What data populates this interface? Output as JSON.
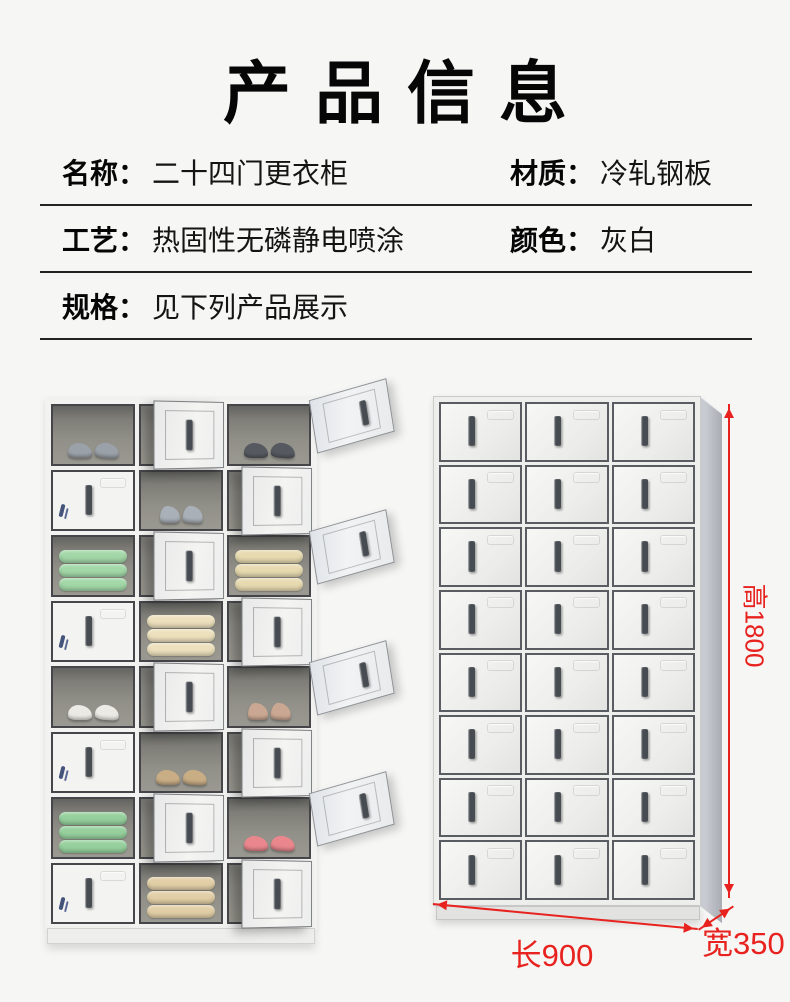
{
  "title": "产品信息",
  "specs": {
    "rows": [
      {
        "left_label": "名称：",
        "left_value": "二十四门更衣柜",
        "right_label": "材质：",
        "right_value": "冷轧钢板"
      },
      {
        "left_label": "工艺：",
        "left_value": "热固性无磷静电喷涂",
        "right_label": "颜色：",
        "right_value": "灰白"
      },
      {
        "left_label": "规格：",
        "left_value": "见下列产品展示",
        "right_label": "",
        "right_value": ""
      }
    ]
  },
  "display": {
    "left_locker": {
      "rows": 8,
      "cols": 3,
      "description": "open 24-door locker showing contents",
      "cells": [
        {
          "type": "open",
          "item": "shoes",
          "color": "#9ba1a8"
        },
        {
          "type": "door"
        },
        {
          "type": "open",
          "item": "shoes",
          "color": "#565a60",
          "outer_door": true
        },
        {
          "type": "closed"
        },
        {
          "type": "open",
          "item": "heels",
          "color": "#a9b0b7"
        },
        {
          "type": "door"
        },
        {
          "type": "open",
          "item": "towels",
          "color": "#a2d7a7"
        },
        {
          "type": "door"
        },
        {
          "type": "open",
          "item": "towels",
          "color": "#e7dab0",
          "outer_door": true
        },
        {
          "type": "closed"
        },
        {
          "type": "open",
          "item": "towels",
          "color": "#ece0bd"
        },
        {
          "type": "door"
        },
        {
          "type": "open",
          "item": "shoes",
          "color": "#eceae5"
        },
        {
          "type": "door"
        },
        {
          "type": "open",
          "item": "heels",
          "color": "#caa793",
          "outer_door": true
        },
        {
          "type": "closed"
        },
        {
          "type": "open",
          "item": "shoes",
          "color": "#c8ad85"
        },
        {
          "type": "door"
        },
        {
          "type": "open",
          "item": "towels",
          "color": "#96d09d"
        },
        {
          "type": "door"
        },
        {
          "type": "open",
          "item": "shoes",
          "color": "#e9878d",
          "outer_door": true
        },
        {
          "type": "closed"
        },
        {
          "type": "open",
          "item": "towels",
          "color": "#e2cfa7"
        },
        {
          "type": "door"
        }
      ]
    },
    "right_locker": {
      "rows": 8,
      "cols": 3,
      "doors": 24,
      "description": "closed 24-door locker"
    },
    "dimensions": {
      "height_label": "高1800",
      "length_label": "长900",
      "width_label": "宽350",
      "line_color": "#e8231f"
    }
  },
  "colors": {
    "background": "#f6f6f5",
    "text": "#111111",
    "divider": "#222222",
    "locker_body": "#f2f2f0",
    "locker_interior": "#8d8c86",
    "lock_blue": "#2c4474",
    "dimension_red": "#e8231f"
  }
}
